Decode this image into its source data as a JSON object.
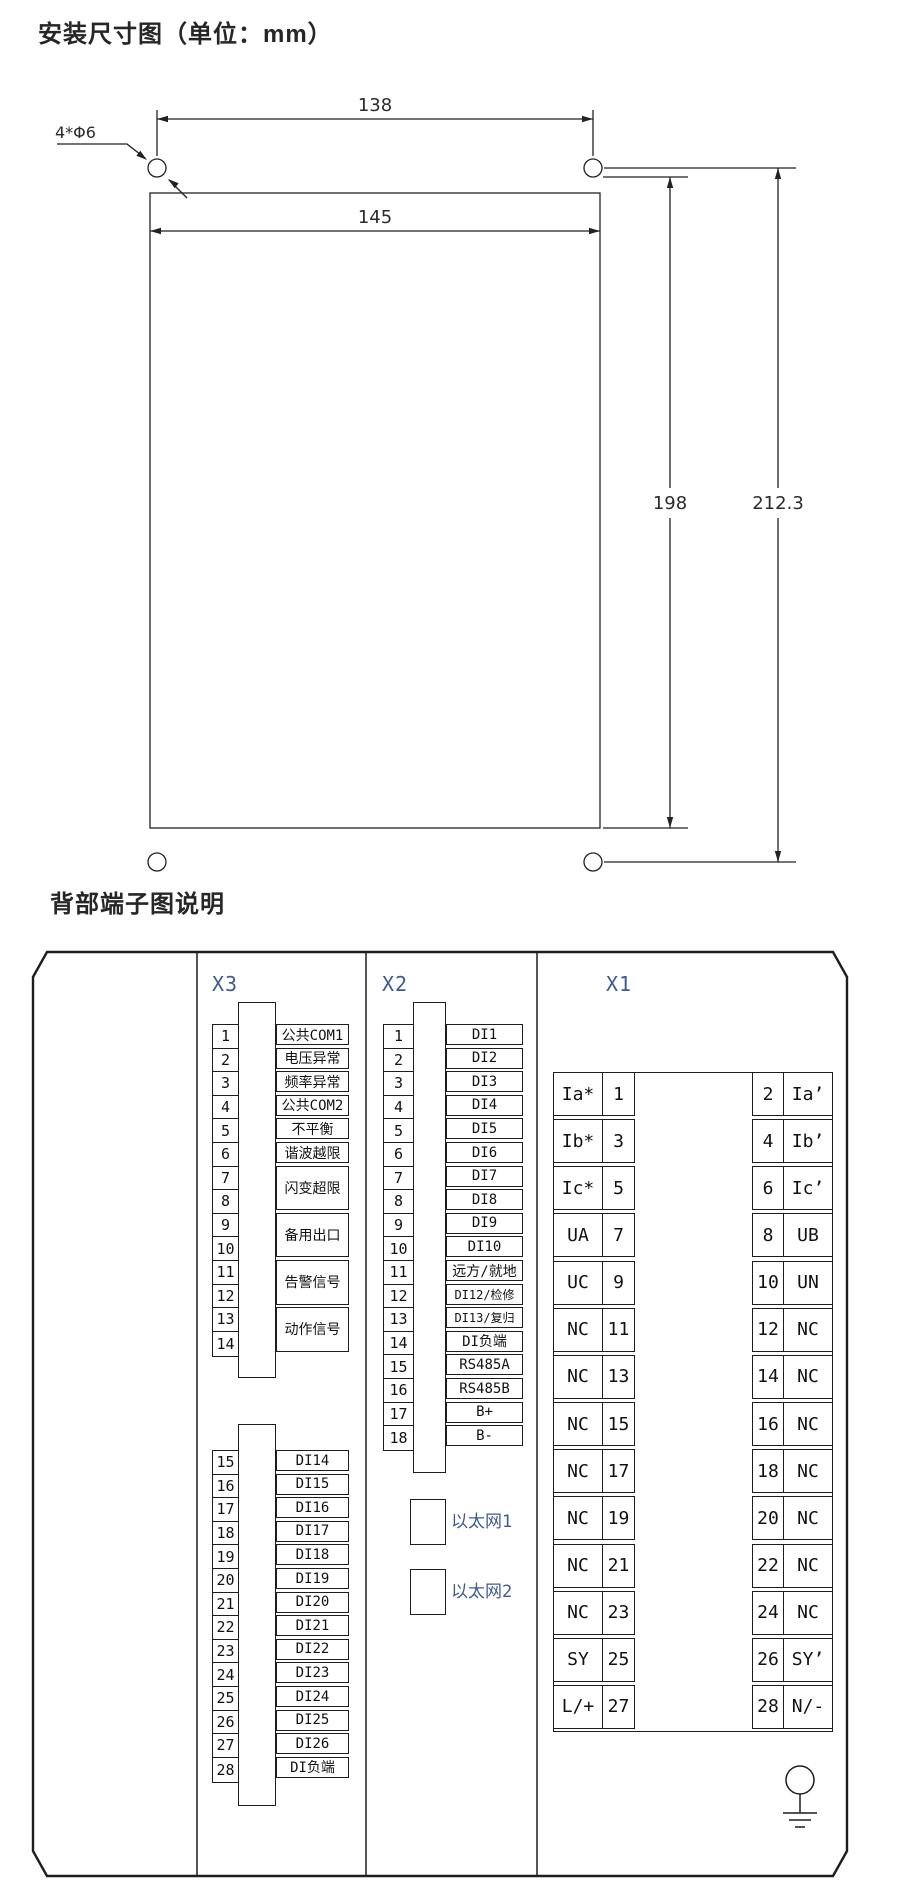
{
  "colors": {
    "background": "#ffffff",
    "line": "#1d1d1d",
    "title_text": "#262626",
    "terminal_text": "#111111",
    "connector_label_blue": "#3e5a8e"
  },
  "dimension_diagram": {
    "title": "安装尺寸图（单位：mm）",
    "hole_spec": "4*Φ6",
    "hole_spacing_width": "138",
    "body_width": "145",
    "body_height": "198",
    "overall_height": "212.3"
  },
  "terminal_diagram": {
    "title": "背部端子图说明",
    "x3": {
      "label": "X3",
      "upper_numbers": [
        "1",
        "2",
        "3",
        "4",
        "5",
        "6",
        "7",
        "8",
        "9",
        "10",
        "11",
        "12",
        "13",
        "14"
      ],
      "upper_labels": [
        {
          "text": "公共COM1",
          "span": 1
        },
        {
          "text": "电压异常",
          "span": 1
        },
        {
          "text": "频率异常",
          "span": 1
        },
        {
          "text": "公共COM2",
          "span": 1
        },
        {
          "text": "不平衡",
          "span": 1
        },
        {
          "text": "谐波越限",
          "span": 1
        },
        {
          "text": "闪变超限",
          "span": 2
        },
        {
          "text": "备用出口",
          "span": 2
        },
        {
          "text": "告警信号",
          "span": 2
        },
        {
          "text": "动作信号",
          "span": 2
        }
      ],
      "lower_numbers": [
        "15",
        "16",
        "17",
        "18",
        "19",
        "20",
        "21",
        "22",
        "23",
        "24",
        "25",
        "26",
        "27",
        "28"
      ],
      "lower_labels": [
        {
          "text": "DI14",
          "span": 1
        },
        {
          "text": "DI15",
          "span": 1
        },
        {
          "text": "DI16",
          "span": 1
        },
        {
          "text": "DI17",
          "span": 1
        },
        {
          "text": "DI18",
          "span": 1
        },
        {
          "text": "DI19",
          "span": 1
        },
        {
          "text": "DI20",
          "span": 1
        },
        {
          "text": "DI21",
          "span": 1
        },
        {
          "text": "DI22",
          "span": 1
        },
        {
          "text": "DI23",
          "span": 1
        },
        {
          "text": "DI24",
          "span": 1
        },
        {
          "text": "DI25",
          "span": 1
        },
        {
          "text": "DI26",
          "span": 1
        },
        {
          "text": "DI负端",
          "span": 1
        }
      ]
    },
    "x2": {
      "label": "X2",
      "numbers": [
        "1",
        "2",
        "3",
        "4",
        "5",
        "6",
        "7",
        "8",
        "9",
        "10",
        "11",
        "12",
        "13",
        "14",
        "15",
        "16",
        "17",
        "18"
      ],
      "labels": [
        {
          "text": "DI1"
        },
        {
          "text": "DI2"
        },
        {
          "text": "DI3"
        },
        {
          "text": "DI4"
        },
        {
          "text": "DI5"
        },
        {
          "text": "DI6"
        },
        {
          "text": "DI7"
        },
        {
          "text": "DI8"
        },
        {
          "text": "DI9"
        },
        {
          "text": "DI10"
        },
        {
          "text": "远方/就地"
        },
        {
          "text": "DI12/检修",
          "small": true
        },
        {
          "text": "DI13/复归",
          "small": true
        },
        {
          "text": "DI负端"
        },
        {
          "text": "RS485A"
        },
        {
          "text": "RS485B"
        },
        {
          "text": "B+"
        },
        {
          "text": "B-"
        }
      ],
      "ethernet": [
        {
          "label": "以太网1"
        },
        {
          "label": "以太网2"
        }
      ]
    },
    "x1": {
      "label": "X1",
      "rows": [
        {
          "left_label": "Ia*",
          "left_num": "1",
          "right_num": "2",
          "right_label": "Ia’"
        },
        {
          "left_label": "Ib*",
          "left_num": "3",
          "right_num": "4",
          "right_label": "Ib’"
        },
        {
          "left_label": "Ic*",
          "left_num": "5",
          "right_num": "6",
          "right_label": "Ic’"
        },
        {
          "left_label": "UA",
          "left_num": "7",
          "right_num": "8",
          "right_label": "UB"
        },
        {
          "left_label": "UC",
          "left_num": "9",
          "right_num": "10",
          "right_label": "UN"
        },
        {
          "left_label": "NC",
          "left_num": "11",
          "right_num": "12",
          "right_label": "NC"
        },
        {
          "left_label": "NC",
          "left_num": "13",
          "right_num": "14",
          "right_label": "NC"
        },
        {
          "left_label": "NC",
          "left_num": "15",
          "right_num": "16",
          "right_label": "NC"
        },
        {
          "left_label": "NC",
          "left_num": "17",
          "right_num": "18",
          "right_label": "NC"
        },
        {
          "left_label": "NC",
          "left_num": "19",
          "right_num": "20",
          "right_label": "NC"
        },
        {
          "left_label": "NC",
          "left_num": "21",
          "right_num": "22",
          "right_label": "NC"
        },
        {
          "left_label": "NC",
          "left_num": "23",
          "right_num": "24",
          "right_label": "NC"
        },
        {
          "left_label": "SY",
          "left_num": "25",
          "right_num": "26",
          "right_label": "SY’"
        },
        {
          "left_label": "L/+",
          "left_num": "27",
          "right_num": "28",
          "right_label": "N/-"
        }
      ]
    }
  }
}
